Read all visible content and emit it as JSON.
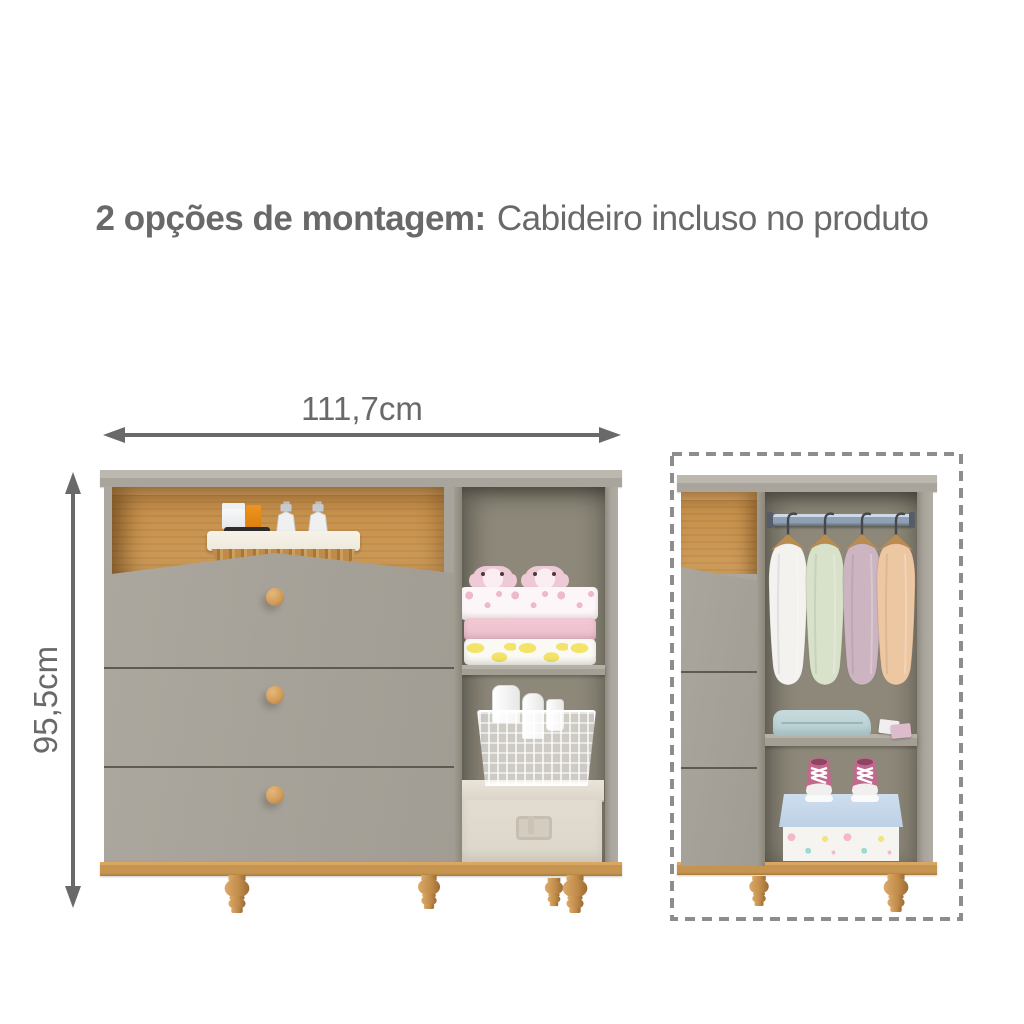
{
  "title": {
    "bold": "2 opções de montagem:",
    "regular": "Cabideiro incluso no produto"
  },
  "dimensions": {
    "width_label": "111,7cm",
    "height_label": "95,5cm"
  },
  "icons": {
    "width_arrow": "double-headed-horizontal-arrow",
    "height_arrow": "double-headed-vertical-arrow",
    "highlight": "dashed-rectangle-outline"
  },
  "palette": {
    "text": "#696969",
    "arrow": "#696969",
    "dash": "#8d8d8d",
    "cab-top": "#bcb8af",
    "cab-front": "#a9a59c",
    "cab-inner": "#8d8879",
    "cab-shelf": "#a49f94",
    "line-dark": "#5e5a52",
    "wood": "#c9944f",
    "wood-light": "#daa763",
    "wood-base": "#c59450",
    "knob": "#d09a58",
    "wicker": "#c08b4a",
    "liner": "#efe9dd",
    "plush": "#eec9d6",
    "blanket-print": "#fdf6f9",
    "blanket-pink": "#f2c9d4",
    "banana": "#f3e469",
    "box-beige": "#ddd6ca",
    "box-blue": "#bdd1e5",
    "box-white": "#f6f4f1",
    "teal": "#b5cdd0",
    "rod": "#8fa0b4",
    "clothes-white": "#f3f2ef",
    "clothes-green": "#d8e1c9",
    "clothes-mauve": "#ccb4c0",
    "clothes-peach": "#edc6a2",
    "sneaker": "#c2688c"
  }
}
